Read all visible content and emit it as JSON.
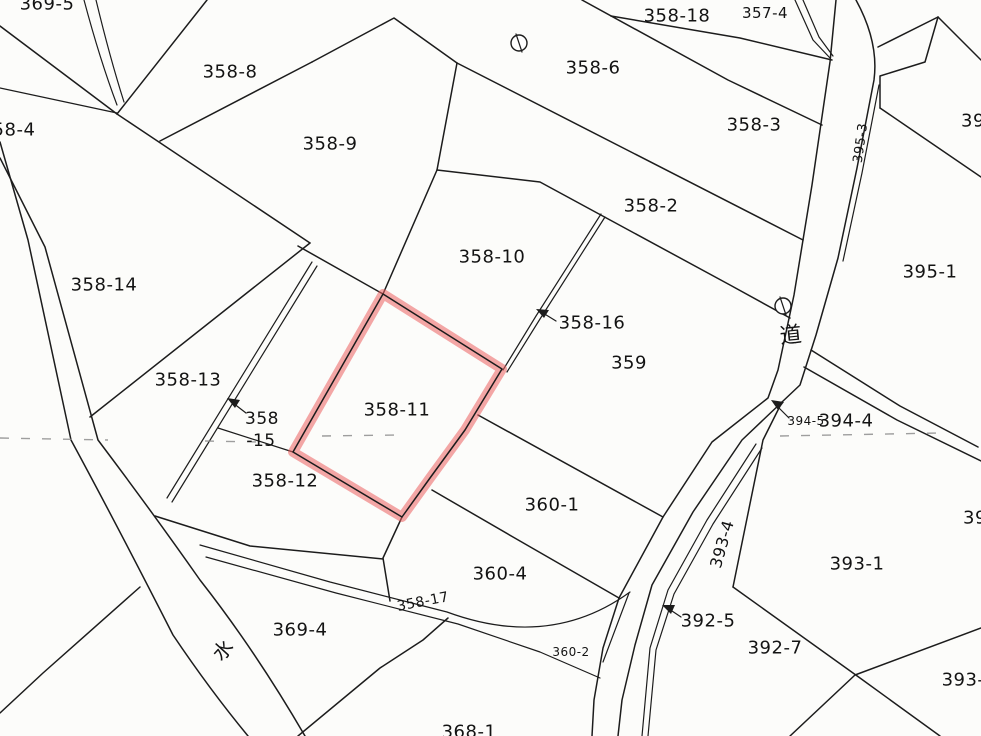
{
  "map": {
    "type": "cadastral-parcel-map",
    "highlight": {
      "parcel": "358-11",
      "color": "#eb5f5f"
    },
    "symbols": {
      "road_kanji": "道",
      "water_kanji": "水",
      "survey_marker": "circle-with-bar"
    },
    "labels": {
      "l369_5": "369-5",
      "l358_8": "358-8",
      "l358_9": "358-9",
      "l358_4": "358-4",
      "l358_6": "358-6",
      "l358_18": "358-18",
      "l357_4": "357-4",
      "l358_3": "358-3",
      "l395_3": "395-3",
      "l39_ne": "39",
      "l358_2": "358-2",
      "l358_10": "358-10",
      "l358_16": "358-16",
      "l359": "359",
      "l395_1": "395-1",
      "road": "道",
      "l358_14": "358-14",
      "l358_13": "358-13",
      "l358_15_line1": "358",
      "l358_15_line2": "-15",
      "l358_12": "358-12",
      "l358_11": "358-11",
      "l360_1": "360-1",
      "l360_4": "360-4",
      "l358_17": "358-17",
      "l360_2": "360-2",
      "l369_4": "369-4",
      "water": "水",
      "l368_1": "368-1",
      "l393_4": "393-4",
      "l392_5": "392-5",
      "l392_7": "392-7",
      "l393_1": "393-1",
      "l394_5": "394-5",
      "l394_4": "394-4",
      "l394_e": "39",
      "l393_se": "393-"
    }
  }
}
